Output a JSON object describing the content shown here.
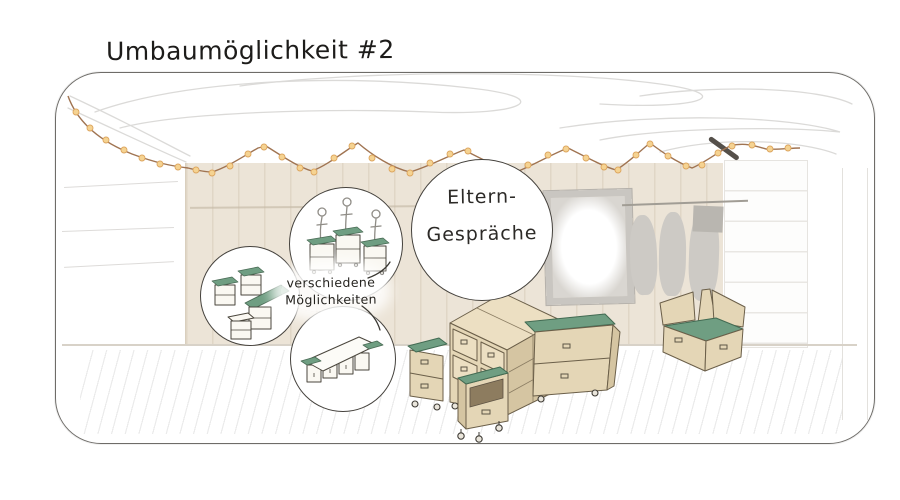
{
  "title": "Umbaumöglichkeit #2",
  "callouts": {
    "main_bubble": {
      "line1": "Eltern-",
      "line2": "Gespräche"
    },
    "options_label": {
      "line1": "verschiedene",
      "line2": "Möglichkeiten"
    }
  },
  "scene": {
    "type": "hand-drawn interior concept sketch",
    "elements": [
      "rounded room frame",
      "ceiling scribbles",
      "string-lights garland with warm bulbs",
      "wood plank back wall",
      "picture frame on wall",
      "coats on wall rail",
      "small wall box",
      "white shelf built-in",
      "cluster of modular drawer carts with green tops",
      "mobile cart on casters",
      "bench with green seat cushion",
      "floor hatching",
      "three idea bubbles with cart arrangement sketches"
    ]
  },
  "colors": {
    "ink": "#2c2a27",
    "accent_green": "#6f9e82",
    "furniture_tan": "#e4d6b6",
    "wood_wall": "#ece4d7",
    "bulb": "#f5d392",
    "bulb_stroke": "#dda65f",
    "wire": "#a07452",
    "coat_gray": "#cdcac5"
  }
}
